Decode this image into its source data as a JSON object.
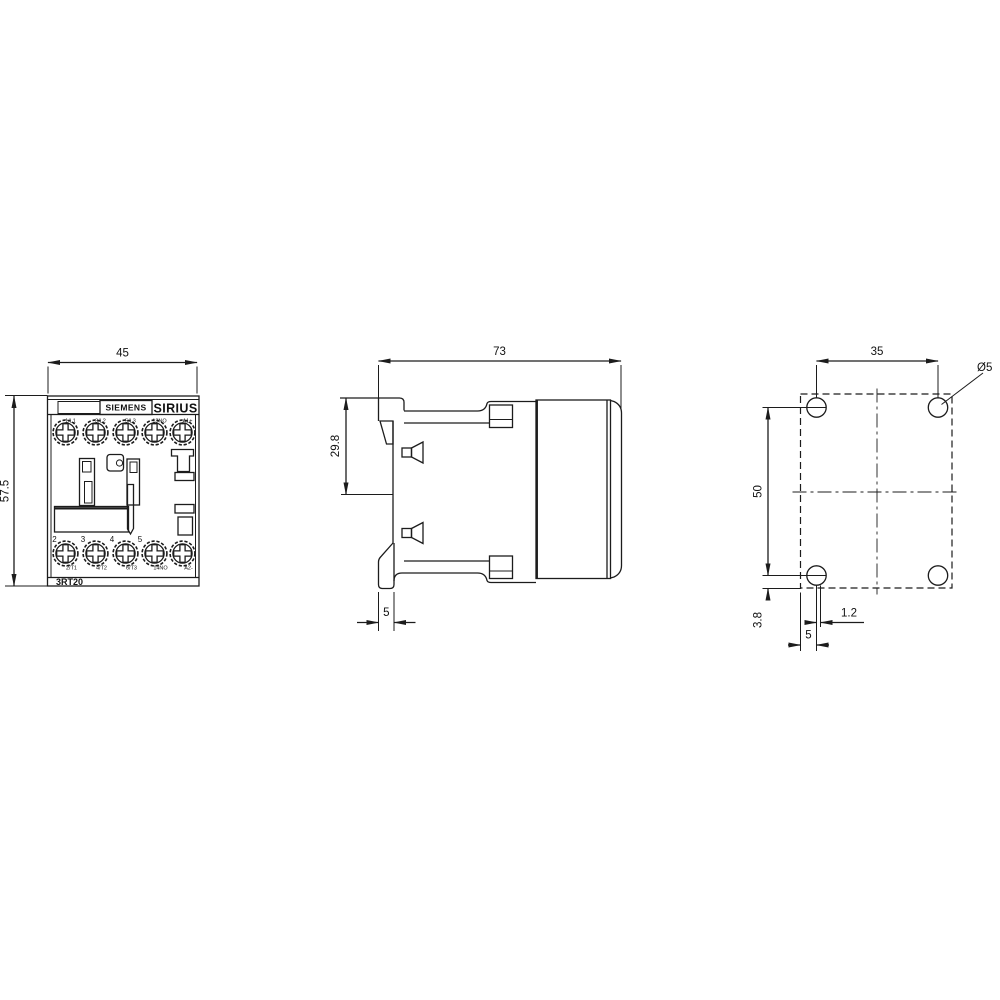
{
  "front_view": {
    "width_mm": "45",
    "height_mm": "57.5",
    "brand": "SIEMENS",
    "series": "SIRIUS",
    "model": "3RT20",
    "top_terminals": [
      "1/L1",
      "3/L2",
      "5/L3",
      "13NO",
      "A1+"
    ],
    "bottom_terminals": [
      "2/T1",
      "4/T2",
      "6/T3",
      "14NO",
      "A2-"
    ],
    "pole_markers": [
      "2",
      "3",
      "4",
      "5"
    ]
  },
  "side_view": {
    "depth_mm": "73",
    "rail_offset_mm": "29.8",
    "flange_mm": "5"
  },
  "rear_view": {
    "hole_pitch_x_mm": "35",
    "hole_pitch_y_mm": "50",
    "hole_diameter": "Ø5",
    "bottom_offset_mm": "3.8",
    "slot_offset_mm": "1.2",
    "edge_offset_mm": "5"
  },
  "colors": {
    "line": "#1c1c1c",
    "background": "#ffffff"
  }
}
